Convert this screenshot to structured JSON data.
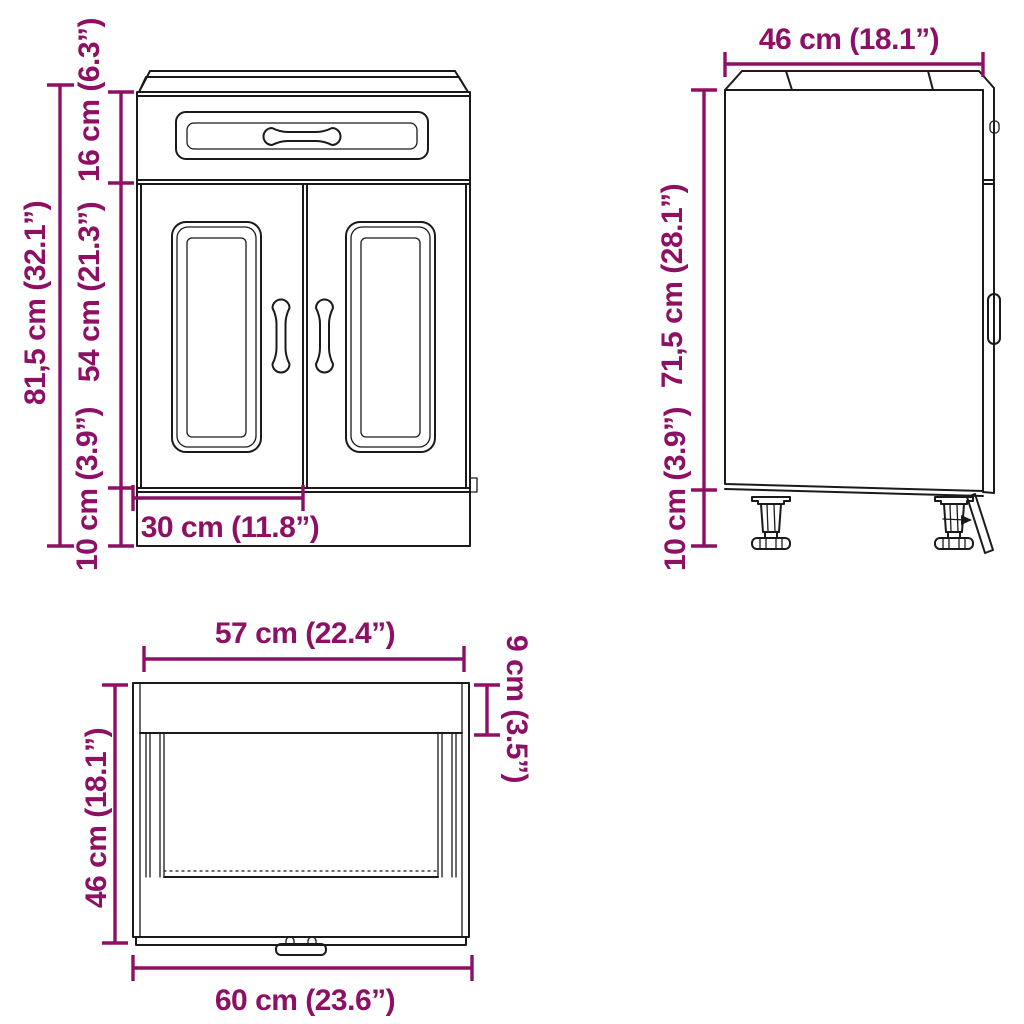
{
  "colors": {
    "dimension": "#8d1064",
    "line": "#1a1a1a",
    "background": "#ffffff"
  },
  "diagram": {
    "type": "product dimension drawing",
    "subject": "kitchen base cabinet with drawer and two doors",
    "views": {
      "front": {
        "total_height": "81,5 cm (32.1”)",
        "drawer_front_height": "16 cm (6.3”)",
        "door_height": "54 cm (21.3”)",
        "plinth_height": "10 cm (3.9”)",
        "door_width": "30 cm (11.8”)"
      },
      "side": {
        "depth": "46 cm (18.1”)",
        "carcass_height": "71,5 cm (28.1”)",
        "leg_height": "10 cm (3.9”)"
      },
      "top": {
        "front_width": "57 cm (22.4”)",
        "back_inset": "9 cm (3.5”)",
        "depth": "46 cm (18.1”)",
        "total_width": "60 cm (23.6”)"
      }
    }
  }
}
